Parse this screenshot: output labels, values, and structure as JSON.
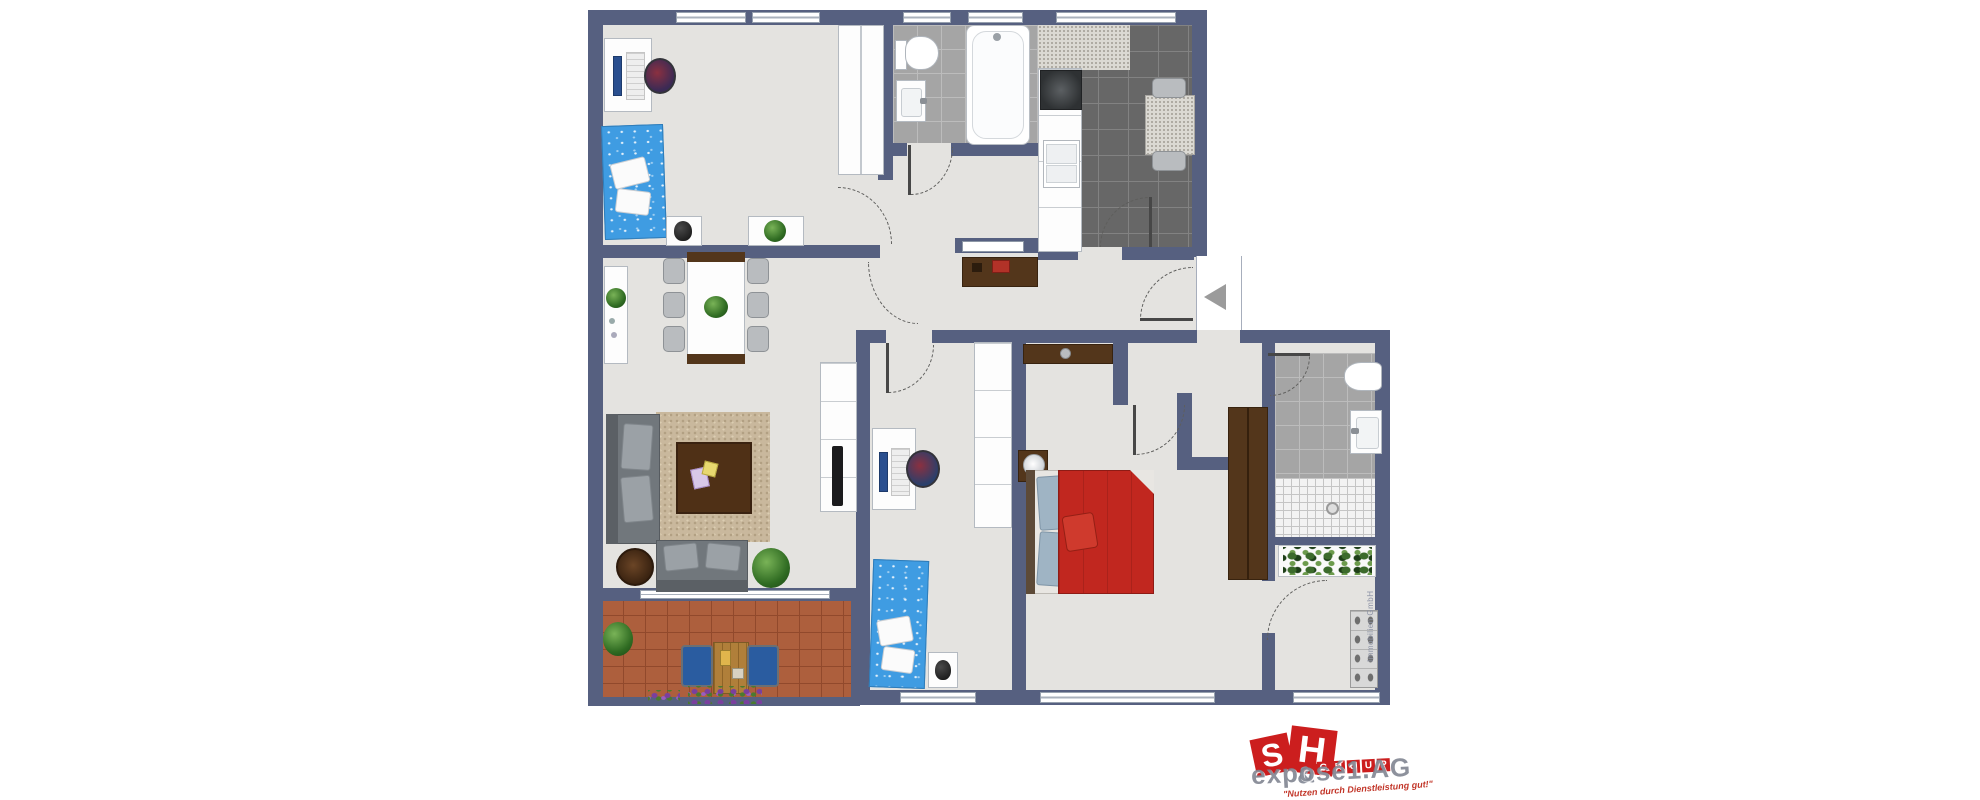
{
  "page": {
    "background": "#ffffff",
    "kind": "apartment floor plan"
  },
  "floor_plan": {
    "rooms": [
      {
        "id": "child-room-top-left"
      },
      {
        "id": "bathroom-top"
      },
      {
        "id": "kitchen"
      },
      {
        "id": "living-room"
      },
      {
        "id": "balcony"
      },
      {
        "id": "small-bedroom"
      },
      {
        "id": "hallway"
      },
      {
        "id": "master-bedroom"
      },
      {
        "id": "shower-bathroom-right"
      },
      {
        "id": "storage-loggia"
      }
    ],
    "entrance_marker": "left-arrow"
  },
  "colors": {
    "wall": "#566080",
    "floor": "#e4e3e0",
    "bath_tile": "#a5a5a5",
    "kitchen_tile": "#676767",
    "balcony_tile": "#ad5f3d",
    "bed_blue": "#3f9ce2",
    "bed_red": "#c1271f",
    "wood_dark": "#53361b",
    "sofa_gray": "#71777c",
    "rug_beige": "#c9b89d",
    "logo_red": "#cc1e1e"
  },
  "logo": {
    "letters": [
      "S",
      "H"
    ],
    "ampersand": "&",
    "group_letters": [
      "G",
      "R",
      "O",
      "U",
      "P"
    ],
    "company": "exposé1.AG",
    "tagline": "\"Nutzen durch Dienstleistung gut!\""
  },
  "watermark": "Immobilien GmbH"
}
